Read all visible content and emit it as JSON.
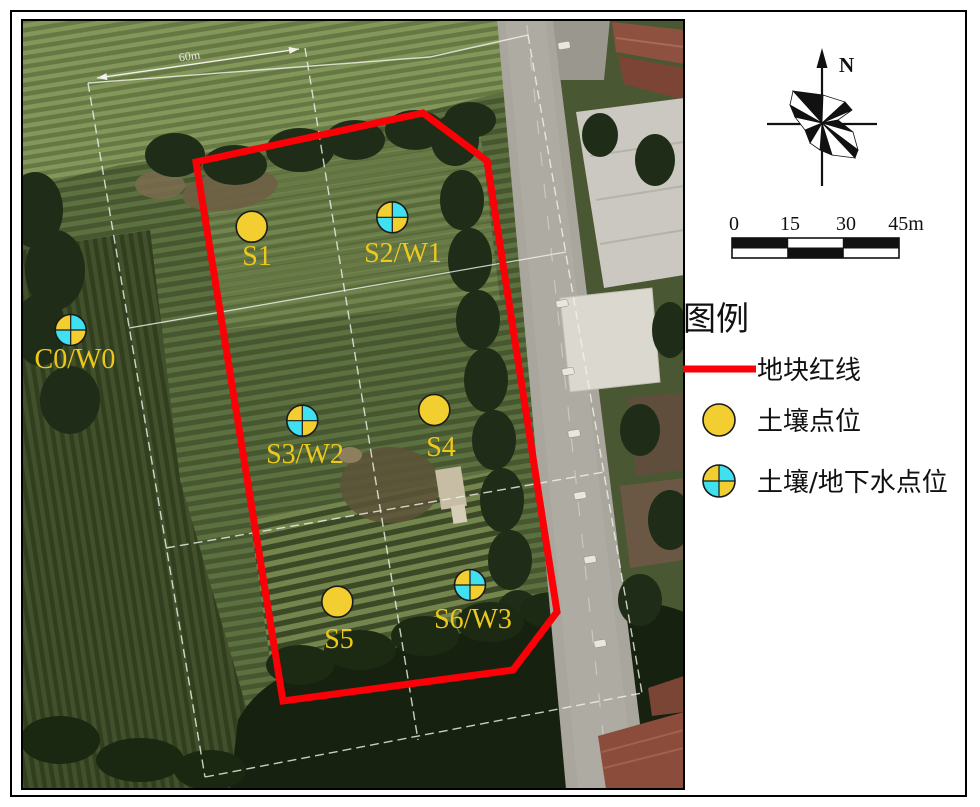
{
  "map": {
    "dimension_label": "60m",
    "boundary": {
      "label": "地块红线",
      "color": "#FB0007"
    },
    "points": [
      {
        "label": "S1",
        "type": "soil"
      },
      {
        "label": "S2/W1",
        "type": "soil_groundwater"
      },
      {
        "label": "C0/W0",
        "type": "soil_groundwater"
      },
      {
        "label": "S3/W2",
        "type": "soil_groundwater"
      },
      {
        "label": "S4",
        "type": "soil"
      },
      {
        "label": "S5",
        "type": "soil"
      },
      {
        "label": "S6/W3",
        "type": "soil_groundwater"
      }
    ]
  },
  "compass": {
    "north_label": "N"
  },
  "scale_bar": {
    "ticks": [
      "0",
      "15",
      "30",
      "45m"
    ]
  },
  "legend": {
    "title": "图例",
    "items": [
      {
        "label": "地块红线",
        "symbol": "red-line"
      },
      {
        "label": "土壤点位",
        "symbol": "yellow-circle"
      },
      {
        "label": "土壤/地下水点位",
        "symbol": "quartered-circle"
      }
    ]
  },
  "colors": {
    "soil_marker": "#F2CE30",
    "groundwater_marker": "#3FE0EF",
    "boundary_red": "#FB0007",
    "label_yellow": "#EEC91B"
  }
}
